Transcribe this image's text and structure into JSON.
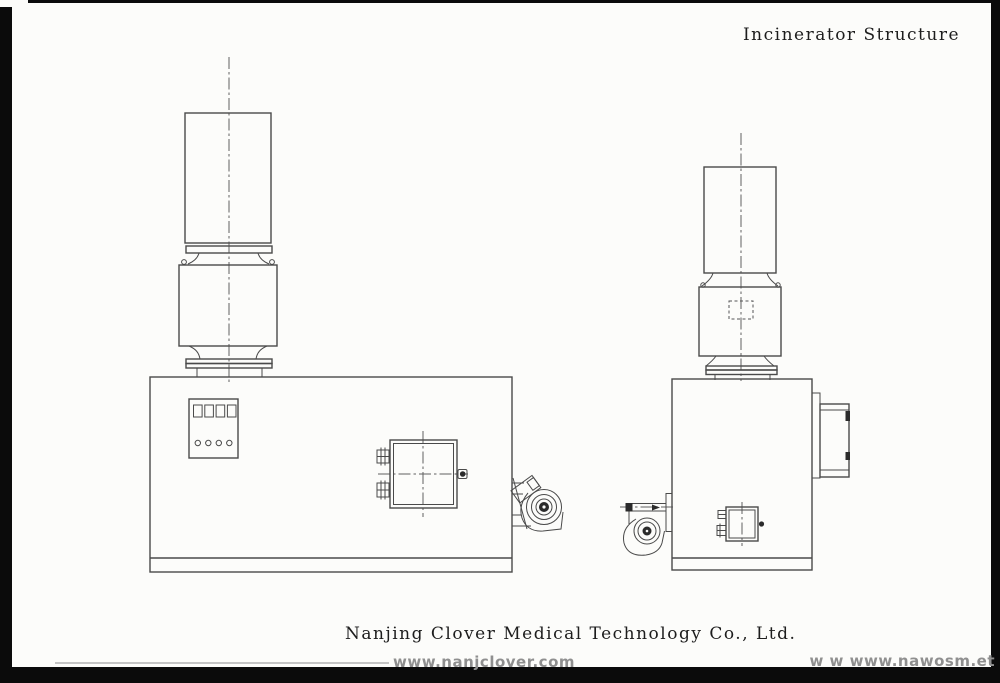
{
  "header": {
    "title": "Incinerator Structure"
  },
  "footer": {
    "company": "Nanjing Clover Medical Technology Co., Ltd.",
    "watermark_center": "www.nanjclover.com",
    "watermark_right": "w w www.nawosm.et"
  },
  "colors": {
    "background": "#fcfcfa",
    "drawing_line": "#4a4a4a",
    "scan_border": "#0b0b0b",
    "watermark": "#8f8f8f"
  }
}
